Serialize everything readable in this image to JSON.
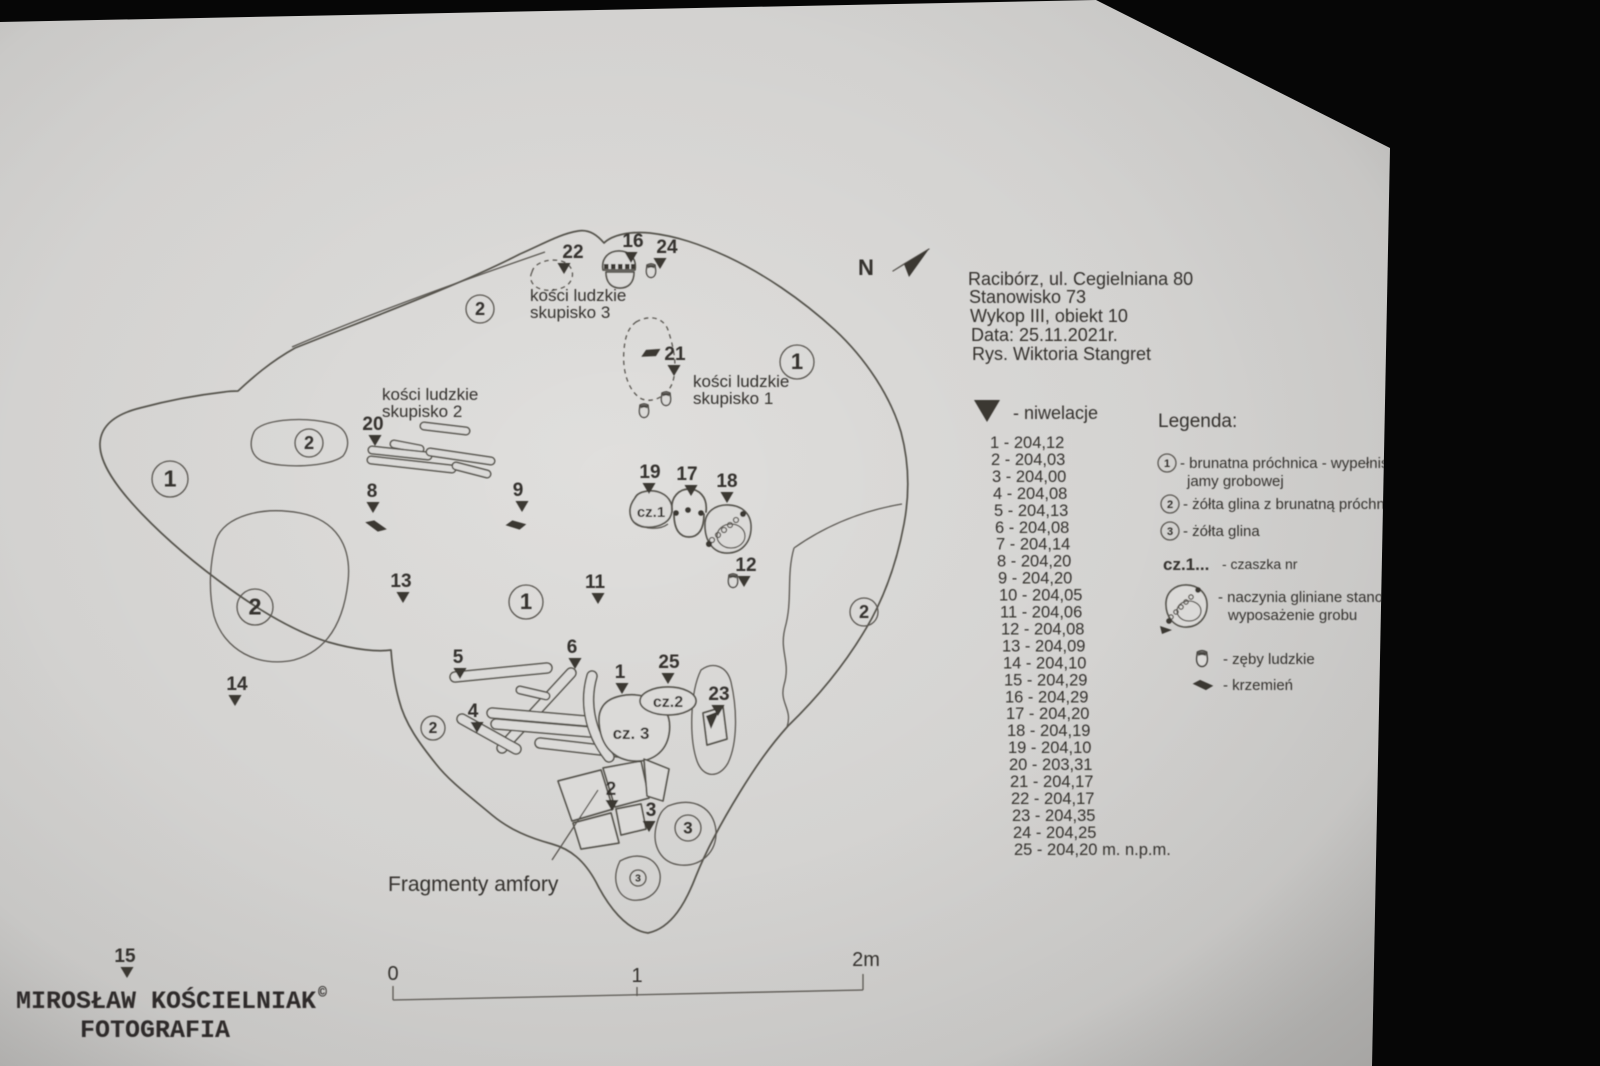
{
  "header": {
    "lines": [
      "Racibórz, ul. Cegielniana 80",
      "Stanowisko 73",
      "Wykop III, obiekt 10",
      "Data: 25.11.2021r.",
      "Rys. Wiktoria Stangret"
    ]
  },
  "niwelacje": {
    "marker_label": "- niwelacje",
    "entries": [
      {
        "n": "1",
        "v": "204,12"
      },
      {
        "n": "2",
        "v": "204,03"
      },
      {
        "n": "3",
        "v": "204,00"
      },
      {
        "n": "4",
        "v": "204,08"
      },
      {
        "n": "5",
        "v": "204,13"
      },
      {
        "n": "6",
        "v": "204,08"
      },
      {
        "n": "7",
        "v": "204,14"
      },
      {
        "n": "8",
        "v": "204,20"
      },
      {
        "n": "9",
        "v": "204,20"
      },
      {
        "n": "10",
        "v": "204,05"
      },
      {
        "n": "11",
        "v": "204,06"
      },
      {
        "n": "12",
        "v": "204,08"
      },
      {
        "n": "13",
        "v": "204,09"
      },
      {
        "n": "14",
        "v": "204,10"
      },
      {
        "n": "15",
        "v": "204,29"
      },
      {
        "n": "16",
        "v": "204,29"
      },
      {
        "n": "17",
        "v": "204,20"
      },
      {
        "n": "18",
        "v": "204,19"
      },
      {
        "n": "19",
        "v": "204,10"
      },
      {
        "n": "20",
        "v": "203,31"
      },
      {
        "n": "21",
        "v": "204,17"
      },
      {
        "n": "22",
        "v": "204,17"
      },
      {
        "n": "23",
        "v": "204,35"
      },
      {
        "n": "24",
        "v": "204,25"
      },
      {
        "n": "25",
        "v": "204,20",
        "suffix": " m. n.p.m."
      }
    ]
  },
  "legenda": {
    "title": "Legenda:",
    "item1": {
      "num": "1",
      "text": "- brunatna próchnica - wypełnisko",
      "text2": "jamy grobowej"
    },
    "item2": {
      "num": "2",
      "text": "- żółta glina z brunatną próchnicą"
    },
    "item3": {
      "num": "3",
      "text": "- żółta glina"
    },
    "item_cz": {
      "prefix": "cz.1...",
      "text": "- czaszka nr"
    },
    "item_vessel": {
      "text": "- naczynia gliniane stanowiące",
      "text2": "wyposażenie grobu"
    },
    "item_tooth": {
      "text": "- zęby ludzkie"
    },
    "item_flint": {
      "text": "- krzemień"
    }
  },
  "plan": {
    "north": "N",
    "labels": {
      "skupisko3_l1": "kości ludzkie",
      "skupisko3_l2": "skupisko 3",
      "skupisko2_l1": "kości ludzkie",
      "skupisko2_l2": "skupisko 2",
      "skupisko1_l1": "kości ludzkie",
      "skupisko1_l2": "skupisko 1",
      "cz1": "cz.1",
      "cz2": "cz.2",
      "cz3": "cz. 3",
      "amphora": "Fragmenty amfory"
    },
    "regions": [
      {
        "label": "2",
        "x": 480,
        "y": 309,
        "r": 14
      },
      {
        "label": "1",
        "x": 797,
        "y": 362,
        "r": 17
      },
      {
        "label": "2",
        "x": 309,
        "y": 443,
        "r": 14
      },
      {
        "label": "1",
        "x": 170,
        "y": 479,
        "r": 18
      },
      {
        "label": "2",
        "x": 255,
        "y": 607,
        "r": 18
      },
      {
        "label": "1",
        "x": 526,
        "y": 602,
        "r": 17
      },
      {
        "label": "2",
        "x": 864,
        "y": 612,
        "r": 14
      },
      {
        "label": "2",
        "x": 433,
        "y": 728,
        "r": 12
      },
      {
        "label": "3",
        "x": 688,
        "y": 828,
        "r": 13
      },
      {
        "label": "3",
        "x": 638,
        "y": 878,
        "r": 8
      }
    ],
    "markers": [
      {
        "n": "22",
        "x": 573,
        "y": 258,
        "dx": -9
      },
      {
        "n": "16",
        "x": 633,
        "y": 247,
        "dx": -2
      },
      {
        "n": "24",
        "x": 667,
        "y": 253,
        "dx": -7
      },
      {
        "n": "21",
        "x": 675,
        "y": 360,
        "dx": -1
      },
      {
        "n": "20",
        "x": 373,
        "y": 430,
        "dx": 2
      },
      {
        "n": "8",
        "x": 372,
        "y": 497,
        "dx": 1
      },
      {
        "n": "9",
        "x": 518,
        "y": 496,
        "dx": 4
      },
      {
        "n": "19",
        "x": 650,
        "y": 478,
        "dx": -1
      },
      {
        "n": "17",
        "x": 687,
        "y": 480,
        "dx": 4
      },
      {
        "n": "18",
        "x": 727,
        "y": 487,
        "dx": 0
      },
      {
        "n": "12",
        "x": 746,
        "y": 571,
        "dx": -2
      },
      {
        "n": "13",
        "x": 401,
        "y": 587,
        "dx": 2
      },
      {
        "n": "11",
        "x": 595,
        "y": 588,
        "dx": 3
      },
      {
        "n": "14",
        "x": 237,
        "y": 690,
        "dx": -2
      },
      {
        "n": "5",
        "x": 458,
        "y": 663,
        "dx": 2
      },
      {
        "n": "6",
        "x": 572,
        "y": 653,
        "dx": 3
      },
      {
        "n": "4",
        "x": 473,
        "y": 717,
        "dx": 4
      },
      {
        "n": "1",
        "x": 620,
        "y": 678,
        "dx": 2
      },
      {
        "n": "25",
        "x": 669,
        "y": 668,
        "dx": -1
      },
      {
        "n": "23",
        "x": 719,
        "y": 700,
        "dx": -1
      },
      {
        "n": "2",
        "x": 611,
        "y": 795,
        "dx": 1
      },
      {
        "n": "3",
        "x": 651,
        "y": 816,
        "dx": -2
      },
      {
        "n": "15",
        "x": 125,
        "y": 962,
        "dx": 2
      }
    ],
    "scale": {
      "t0": "0",
      "t1": "1",
      "t2": "2m"
    }
  },
  "watermark": {
    "name": "MIROSŁAW KOŚCIELNIAK",
    "copyright": "©",
    "line2": "FOTOGRAFIA"
  },
  "colors": {
    "ink": "#55524c",
    "text_ink": "#34322e",
    "paper": "#dbdad8",
    "backdrop": "#060606"
  }
}
